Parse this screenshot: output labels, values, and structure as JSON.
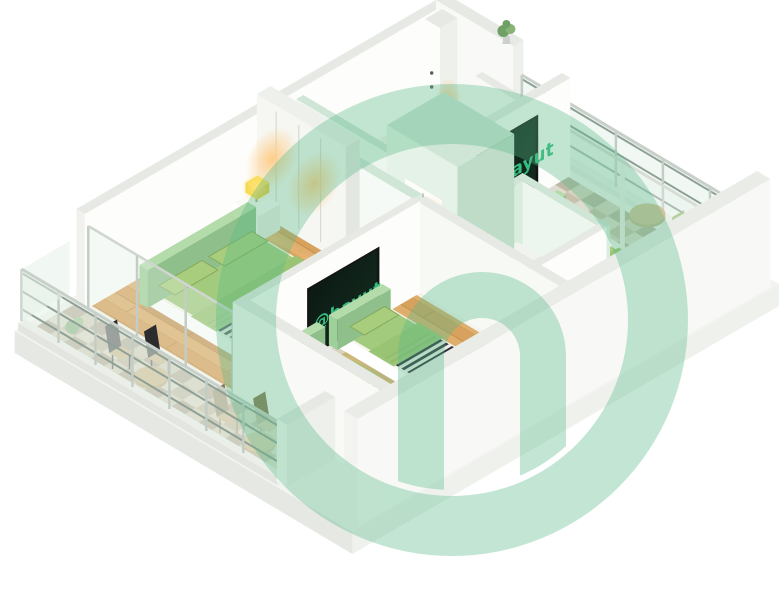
{
  "window": {
    "width": 782,
    "height": 608,
    "background": "#ffffff"
  },
  "brand": {
    "tv_screen_label": "@bayut",
    "tv_label_color": "#35bd80",
    "watermark_shape": "bayut-at-monogram",
    "watermark_color": "#58ba89",
    "watermark_opacity": 0.36
  },
  "scene": {
    "type": "isometric-3d-floor-plan-render",
    "rooms": [
      "bedroom-left",
      "bedroom-kids",
      "bedroom-master",
      "bathroom",
      "hallway",
      "balcony-southwest",
      "balcony-northeast"
    ],
    "furniture": [
      "double-bed",
      "twin-bed",
      "twin-bed",
      "master-bed",
      "tv-unit",
      "tv-unit",
      "wardrobe",
      "center-wardrobe",
      "nightstand",
      "table-lamp",
      "toilet",
      "outdoor-table",
      "outdoor-chair",
      "potted-plant"
    ]
  },
  "palette": {
    "wallWhite": "#f9faf7",
    "wallBright": "#fdfdfb",
    "wallTop": "#e7e9e4",
    "wallSide": "#eef0eb",
    "wallEnd": "#f1f2ee",
    "mintFace": "#d9eddd",
    "mintBright": "#ecf6ee",
    "mintTop": "#cfe5d6",
    "mintDeep": "#bfdcc9",
    "floorWoodA": "#dfae6c",
    "floorWoodB": "#d6a25e",
    "woodLine": "#c08d49",
    "floorPale": "#f4f5f1",
    "bathFloor": "#e9efe7",
    "baseTop": "#f3f4f1",
    "tileA": "#d9d2bf",
    "tileB": "#b9aa8c",
    "tileC": "#a79a80",
    "tileD": "#cfc5aa",
    "glass": "#e6f2ea",
    "glassRail": "#8fa096",
    "glassPost": "#c3cdc5",
    "bedGreen": "#a3cb7e",
    "headGreen": "#9ed09a",
    "pillowGreen": "#a8cd7c",
    "throwGreen": "#97c474",
    "stripeDark": "#2e2e3e",
    "stripeLight": "#efefe5",
    "mattress": "#f6f6ef",
    "baseSide": "#e9e9e1",
    "shadow": "rgba(70,80,70,0.10)",
    "darkFrame": "#4c514e",
    "screenDark": "#0b1b13",
    "tvBezel": "#141414",
    "matGreen": "#5d8a63",
    "lampYellow": "#f4d63e",
    "plantGreen": "#6fa065",
    "plantLight": "#87b377",
    "potGray": "#cdd1cb",
    "chairBlack": "#2c2c2e",
    "seatTan": "#c8aa74",
    "tableTan": "#c9ab72",
    "tableEdge": "#b59a62",
    "chairGreen": "#9cbf77",
    "slabFace": "#e6e8e4",
    "slabSide": "#eff1ed",
    "rugGreen": "#a9d693",
    "washGreen": "#abd7a0",
    "glowWarm": "#ffc97e",
    "glowYellow": "#ffe27a",
    "glowMint": "#bfe9cb"
  }
}
